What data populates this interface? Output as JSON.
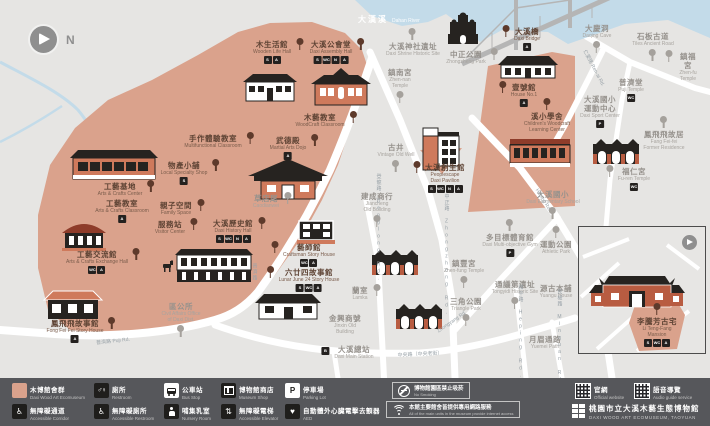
{
  "meta": {
    "title": "Daxi Wood Art Ecomuseum map",
    "width": 710,
    "height": 426
  },
  "colors": {
    "background": "#e6e5e3",
    "museum_area": "#daa28c",
    "river": "#c3dbe9",
    "road": "#ffffff",
    "legend_bar": "#56575b",
    "museum_text": "#5e4334",
    "poi_text": "#96928d",
    "building_dark": "#262320",
    "building_brick": "#b85c41"
  },
  "compass": {
    "label": "N"
  },
  "river_label": {
    "zh": "大漢溪",
    "en": "Dahan River"
  },
  "museum_sites": [
    {
      "id": "wooden-life-hall",
      "zh": "木生活館",
      "en": "Wooden Life Hall",
      "x": 272,
      "y": 40,
      "tree": "right",
      "badges": [
        "shop",
        "accessible"
      ]
    },
    {
      "id": "daxi-assembly-hall",
      "zh": "大溪公會堂",
      "en": "Daxi Assembly Hall",
      "x": 331,
      "y": 40,
      "tree": "right",
      "badges": [
        "shop",
        "restroom",
        "nursery",
        "accessible"
      ]
    },
    {
      "id": "woodcraft-classroom",
      "zh": "木藝教室",
      "en": "WoodCraft Classroom",
      "x": 320,
      "y": 113,
      "tree": "right",
      "badges": []
    },
    {
      "id": "martial-arts-dojo",
      "zh": "武德殿",
      "en": "Martial Arts Dojo",
      "x": 288,
      "y": 136,
      "tree": "right",
      "badges": [
        "accessible"
      ]
    },
    {
      "id": "multifunction-classroom",
      "zh": "手作體驗教室",
      "en": "Multifunctional Classroom",
      "x": 213,
      "y": 134,
      "tree": "right",
      "badges": []
    },
    {
      "id": "local-specialty-shop",
      "zh": "物產小舖",
      "en": "Local Specialty Shop",
      "x": 184,
      "y": 161,
      "tree": "right",
      "badges": [
        "shop"
      ]
    },
    {
      "id": "family-space",
      "zh": "親子空間",
      "en": "Family Space",
      "x": 176,
      "y": 201,
      "tree": "right",
      "badges": []
    },
    {
      "id": "service-station",
      "zh": "服務站",
      "en": "Visitor Center",
      "x": 170,
      "y": 220,
      "tree": "right",
      "badges": []
    },
    {
      "id": "arts-crafts-center",
      "zh": "工藝基地",
      "en": "Arts & Crafts Center",
      "x": 120,
      "y": 182,
      "tree": "right",
      "badges": []
    },
    {
      "id": "arts-crafts-classroom",
      "zh": "工藝教室",
      "en": "Arts & Crafts Classroom",
      "x": 122,
      "y": 199,
      "tree": "none",
      "badges": [
        "accessible"
      ]
    },
    {
      "id": "arts-crafts-exchange-hall",
      "zh": "工藝交流館",
      "en": "Arts & Crafts Exchange Hall",
      "x": 97,
      "y": 250,
      "tree": "right",
      "badges": [
        "restroom",
        "accessible"
      ]
    },
    {
      "id": "fong-fei-fei-story-house",
      "zh": "鳳飛飛故事館",
      "en": "Fong Fei Fei Story House",
      "x": 75,
      "y": 319,
      "tree": "right",
      "badges": [
        "accessible"
      ]
    },
    {
      "id": "daxi-history-hall",
      "zh": "大溪歷史館",
      "en": "Daxi History Hall",
      "x": 233,
      "y": 219,
      "tree": "right",
      "badges": [
        "shop",
        "restroom",
        "nursery",
        "accessible"
      ]
    },
    {
      "id": "craftsman-story-house",
      "zh": "藝師館",
      "en": "Craftsman Story House",
      "x": 309,
      "y": 243,
      "tree": "left",
      "badges": [
        "restroom",
        "accessible"
      ]
    },
    {
      "id": "lunar-june-24-story-house",
      "zh": "六廿四故事館",
      "en": "Lunar June 24 Story House",
      "x": 309,
      "y": 268,
      "tree": "left",
      "badges": [
        "shop",
        "restroom",
        "accessible"
      ]
    },
    {
      "id": "peoplescape-daxi-pavilion",
      "zh": "大溪創生館",
      "en": "Peoplescape\nDaxi Pavilion",
      "x": 445,
      "y": 163,
      "tree": "left",
      "badges": [
        "shop",
        "restroom",
        "nursery",
        "accessible"
      ]
    },
    {
      "id": "house-no-1",
      "zh": "壹號館",
      "en": "House No.1",
      "x": 524,
      "y": 83,
      "tree": "left",
      "badges": [
        "accessible"
      ]
    },
    {
      "id": "children-woodcraft-learning-center",
      "zh": "溪小學舍",
      "en": "Children's Woodcraft\nLearning Center",
      "x": 547,
      "y": 112,
      "tree": "above",
      "badges": []
    },
    {
      "id": "daxi-bridge",
      "zh": "大溪橋",
      "en": "Daxi Bridge",
      "x": 527,
      "y": 27,
      "tree": "left",
      "badges": [
        "accessible"
      ]
    }
  ],
  "poi_sites": [
    {
      "id": "daxi-shrine-historic-site",
      "zh": "大溪神社遺址",
      "en": "Daxi Shrine Historic Site",
      "x": 413,
      "y": 42,
      "tree": "above"
    },
    {
      "id": "zhen-nan-temple",
      "zh": "鎮南宮",
      "en": "Zhen-nan\nTemple",
      "x": 400,
      "y": 68,
      "tree": "below"
    },
    {
      "id": "zhongzheng-park",
      "zh": "中正公園",
      "en": "Zhongzheng Park",
      "x": 466,
      "y": 50,
      "tree": "right"
    },
    {
      "id": "daqing-cave",
      "zh": "大慶洞",
      "en": "Daqing Cave",
      "x": 597,
      "y": 24,
      "tree": "below"
    },
    {
      "id": "tiles-ancient-road",
      "zh": "石板古道",
      "en": "Tiles Ancient Road",
      "x": 653,
      "y": 32,
      "tree": "below"
    },
    {
      "id": "zhen-fu-temple",
      "zh": "鎮福宮",
      "en": "Zhen-fu\nTemple",
      "x": 688,
      "y": 52,
      "tree": "left"
    },
    {
      "id": "puji-temple",
      "zh": "普濟堂",
      "en": "Puji Temple",
      "x": 631,
      "y": 78,
      "badges": [
        "restroom"
      ]
    },
    {
      "id": "daxi-sport-center",
      "zh": "大溪國小\n運動中心",
      "en": "Daxi Sport Center",
      "x": 600,
      "y": 95,
      "badges": [
        "parking"
      ]
    },
    {
      "id": "fang-fei-fei-former-residence",
      "zh": "鳳飛飛故居",
      "en": "Fang Fei-fei\nFormer Residence",
      "x": 664,
      "y": 130,
      "tree": "above"
    },
    {
      "id": "fu-ren-temple",
      "zh": "福仁宮",
      "en": "Fu-ren Temple",
      "x": 634,
      "y": 167,
      "tree": "left",
      "badges": [
        "restroom"
      ]
    },
    {
      "id": "daxi-elementary-school",
      "zh": "大溪國小",
      "en": "Daxi Elementary School",
      "x": 553,
      "y": 190,
      "tree": "below"
    },
    {
      "id": "vintage-old-well",
      "zh": "古井",
      "en": "Vintage Old Well",
      "x": 396,
      "y": 143,
      "tree": "below"
    },
    {
      "id": "jiancheng-old-building",
      "zh": "建成商行",
      "en": "Jiancheng\nOld Building",
      "x": 377,
      "y": 192,
      "tree": "below"
    },
    {
      "id": "caodianwei",
      "zh": "草店尾",
      "en": "Caodianwei",
      "x": 266,
      "y": 194,
      "tree": "right"
    },
    {
      "id": "civil-affairs-office",
      "zh": "區公所",
      "en": "Civil Affairs Office\nof Daxi Dist.",
      "x": 181,
      "y": 302,
      "tree": "below"
    },
    {
      "id": "lamka",
      "zh": "蘭室",
      "en": "Lamka",
      "x": 360,
      "y": 286,
      "tree": "right"
    },
    {
      "id": "jinxin-old-building",
      "zh": "金興商號",
      "en": "Jinxin Old\nBuilding",
      "x": 345,
      "y": 314
    },
    {
      "id": "daxi-main-station",
      "zh": "大溪總站",
      "en": "Daxi Main Station",
      "x": 354,
      "y": 345,
      "badges": [
        "bus"
      ],
      "badge_side": "left"
    },
    {
      "id": "triangle-park",
      "zh": "三角公園",
      "en": "Triangle Park",
      "x": 466,
      "y": 297,
      "tree": "below"
    },
    {
      "id": "zhen-fung-temple",
      "zh": "鎮豐宮",
      "en": "Zhen-fung Temple",
      "x": 464,
      "y": 259,
      "tree": "below"
    },
    {
      "id": "multi-objective-gym",
      "zh": "多目標體育館",
      "en": "Daxi Multi-objective Gym",
      "x": 510,
      "y": 233,
      "tree": "above",
      "badges": [
        "parking"
      ]
    },
    {
      "id": "tongyidi-historic-site",
      "zh": "通議第遺址",
      "en": "Tongyidi Historic Site",
      "x": 515,
      "y": 280,
      "tree": "below"
    },
    {
      "id": "yuangu-house",
      "zh": "源古本舖",
      "en": "Yuangu House",
      "x": 556,
      "y": 284
    },
    {
      "id": "athletic-park",
      "zh": "運動公園",
      "en": "Athletic Park",
      "x": 556,
      "y": 240,
      "tree": "above"
    },
    {
      "id": "yuemei-path",
      "zh": "月眉通路",
      "en": "Yuemei Path",
      "x": 545,
      "y": 335
    }
  ],
  "inset": {
    "site": {
      "id": "li-teng-fang-mansion",
      "zh": "李騰芳古宅",
      "en": "Li Teng-Fang Mansion",
      "badges": [
        "shop",
        "restroom",
        "accessible"
      ]
    }
  },
  "roads": [
    {
      "text": "普濟路 Puji Rd.",
      "x": 113,
      "y": 341,
      "rotate": -6
    },
    {
      "text": "普濟路",
      "x": 255,
      "y": 272,
      "vertical": true
    },
    {
      "text": "登龍路 Denglong Rd.",
      "x": 379,
      "y": 228,
      "vertical": true
    },
    {
      "text": "中正路 Zhongzheng Rd.",
      "x": 447,
      "y": 255,
      "vertical": true
    },
    {
      "text": "中央路（中央老街）",
      "x": 420,
      "y": 354,
      "rotate": -3
    },
    {
      "text": "Zhongyang Rd.",
      "x": 452,
      "y": 322,
      "rotate": -35
    },
    {
      "text": "Heping Rd.",
      "x": 543,
      "y": 200,
      "rotate": 58
    },
    {
      "text": "和平路 Heping Rd.",
      "x": 521,
      "y": 332,
      "vertical": true
    },
    {
      "text": "民權路 Minquan Rd.",
      "x": 560,
      "y": 340,
      "vertical": true
    },
    {
      "text": "仁愛路 Ren-ai Rd.",
      "x": 594,
      "y": 68,
      "rotate": 62
    }
  ],
  "legend": {
    "items": [
      {
        "icon": "area-swatch",
        "zh": "木博館舍群",
        "en": "Daxi Wood Art Ecomuseum"
      },
      {
        "icon": "restroom",
        "zh": "廁所",
        "en": "Restroom"
      },
      {
        "icon": "bus-stop",
        "zh": "公車站",
        "en": "Bus Stop"
      },
      {
        "icon": "museum-shop",
        "zh": "博物館商店",
        "en": "Museum Shop"
      },
      {
        "icon": "parking",
        "zh": "停車場",
        "en": "Parking Lot"
      },
      {
        "icon": "accessible-corridor",
        "zh": "無障礙通道",
        "en": "Accessible Corridor"
      },
      {
        "icon": "accessible-restroom",
        "zh": "無障礙廁所",
        "en": "Accessible Restroom"
      },
      {
        "icon": "nursery",
        "zh": "哺集乳室",
        "en": "Nursery Room"
      },
      {
        "icon": "accessible-elevator",
        "zh": "無障礙電梯",
        "en": "Accessible Elevator"
      },
      {
        "icon": "aed",
        "zh": "自動體外心臟電擊去顫器",
        "en": "AED"
      }
    ],
    "notes": [
      {
        "icon": "no-smoking",
        "zh": "博物館園區禁止吸菸",
        "en": "No Smoking"
      },
      {
        "icon": "wifi",
        "zh": "本館主要館舍皆提供專用網路服務",
        "en": "All of the main units in the museum provide internet access"
      }
    ],
    "qr": [
      {
        "zh": "官網",
        "en": "Official website"
      },
      {
        "zh": "語音導覽",
        "en": "Audio guide service"
      }
    ],
    "brand": {
      "zh": "桃園市立大溪木藝生態博物館",
      "en": "DAXI WOOD ART ECOMUSEUM, TAOYUAN"
    }
  }
}
